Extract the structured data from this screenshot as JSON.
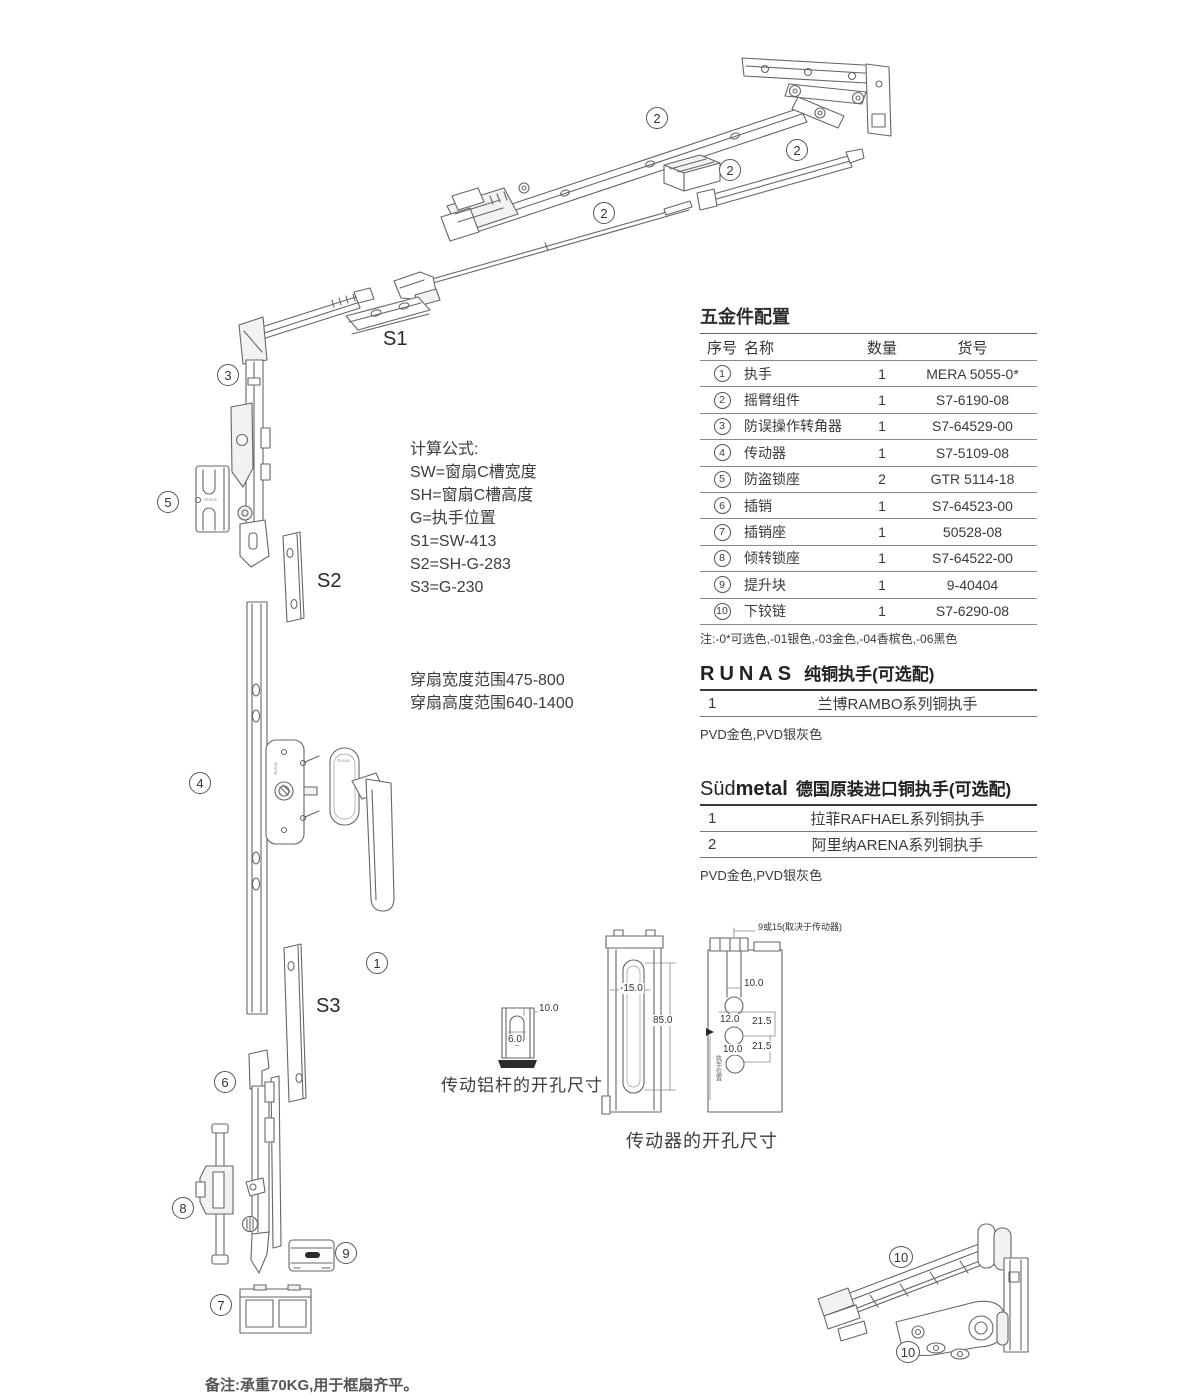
{
  "branding": {
    "part_logo": "Runas"
  },
  "callouts": {
    "c1": "1",
    "c2": "2",
    "c3": "3",
    "c4": "4",
    "c5": "5",
    "c6": "6",
    "c7": "7",
    "c8": "8",
    "c9": "9",
    "c10": "10"
  },
  "strip_labels": {
    "s1": "S1",
    "s2": "S2",
    "s3": "S3"
  },
  "formulas": {
    "title": "计算公式:",
    "lines": [
      "SW=窗扇C槽宽度",
      "SH=窗扇C槽高度",
      "G=执手位置",
      "S1=SW-413",
      "S2=SH-G-283",
      "S3=G-230"
    ]
  },
  "range": {
    "width_line": "穿扇宽度范围475-800",
    "height_line": "穿扇高度范围640-1400"
  },
  "hardware_table": {
    "title": "五金件配置",
    "headers": {
      "no": "序号",
      "name": "名称",
      "qty": "数量",
      "code": "货号"
    },
    "rows": [
      {
        "no": "1",
        "name": "执手",
        "qty": "1",
        "code": "MERA 5055-0*"
      },
      {
        "no": "2",
        "name": "摇臂组件",
        "qty": "1",
        "code": "S7-6190-08"
      },
      {
        "no": "3",
        "name": "防误操作转角器",
        "qty": "1",
        "code": "S7-64529-00"
      },
      {
        "no": "4",
        "name": "传动器",
        "qty": "1",
        "code": "S7-5109-08"
      },
      {
        "no": "5",
        "name": "防盗锁座",
        "qty": "2",
        "code": "GTR 5114-18"
      },
      {
        "no": "6",
        "name": "插销",
        "qty": "1",
        "code": "S7-64523-00"
      },
      {
        "no": "7",
        "name": "插销座",
        "qty": "1",
        "code": "50528-08"
      },
      {
        "no": "8",
        "name": "倾转锁座",
        "qty": "1",
        "code": "S7-64522-00"
      },
      {
        "no": "9",
        "name": "提升块",
        "qty": "1",
        "code": "9-40404"
      },
      {
        "no": "10",
        "name": "下铰链",
        "qty": "1",
        "code": "S7-6290-08"
      }
    ],
    "note": "注:-0*可选色,-01银色,-03金色,-04香槟色,-06黑色"
  },
  "runas_section": {
    "brand": "RUNAS",
    "title": "纯铜执手(可选配)",
    "rows": [
      {
        "no": "1",
        "name": "兰博RAMBO系列铜执手"
      }
    ],
    "note": "PVD金色,PVD银灰色"
  },
  "sudmetal_section": {
    "brand_light": "Süd",
    "brand_bold": "metal",
    "title": "德国原装进口铜执手(可选配)",
    "rows": [
      {
        "no": "1",
        "name": "拉菲RAFHAEL系列铜执手"
      },
      {
        "no": "2",
        "name": "阿里纳ARENA系列铜执手"
      }
    ],
    "note": "PVD金色,PVD银灰色"
  },
  "dim_alu": {
    "label": "传动铝杆的开孔尺寸",
    "d_width": "10.0",
    "d_slot": "6.0"
  },
  "dim_driver": {
    "label": "传动器的开孔尺寸",
    "top_note": "9或15(取决于传动器)",
    "profile_slot_width": "-15.0",
    "profile_slot_height": "85.0",
    "d1": "10.0",
    "d2": "12.0",
    "d3": "21.5",
    "d4": "10.0",
    "d5": "21.5",
    "side_text": "执手位置"
  },
  "footer": {
    "note": "备注:承重70KG,用于框扇齐平。"
  }
}
